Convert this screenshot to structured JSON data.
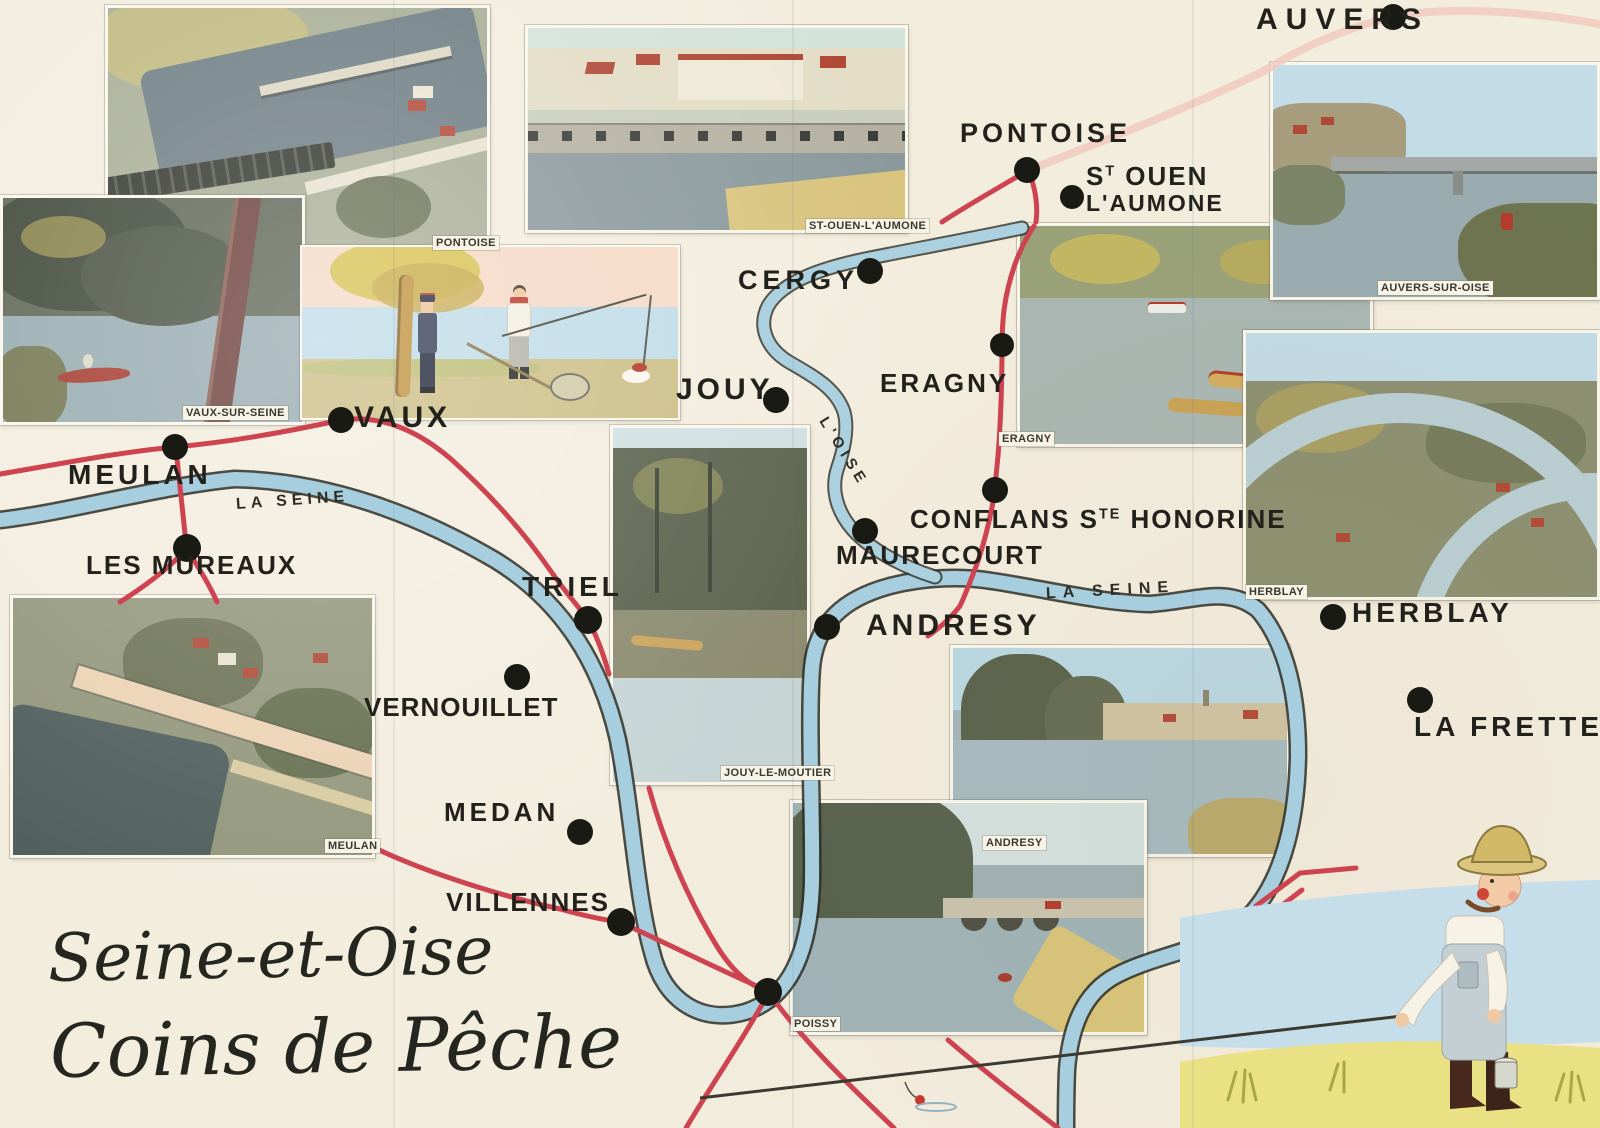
{
  "title": {
    "line1": "Seine-et-Oise",
    "line2": "Coins de Pêche"
  },
  "towns": [
    {
      "id": "auvers",
      "label": "AUVERS"
    },
    {
      "id": "pontoise",
      "label": "PONTOISE"
    },
    {
      "id": "st-ouen-l-aumone",
      "line1_s": "S",
      "line1_sup": "T",
      "line1_rest": " OUEN",
      "line2": "L'AUMONE"
    },
    {
      "id": "cergy",
      "label": "CERGY"
    },
    {
      "id": "jouy",
      "label": "JOUY"
    },
    {
      "id": "eragny",
      "label": "ERAGNY"
    },
    {
      "id": "conflans-ste-honorine",
      "p1": "CONFLANS S",
      "sup": "TE",
      "p2": " HONORINE"
    },
    {
      "id": "maurecourt",
      "label": "MAURECOURT"
    },
    {
      "id": "andresy",
      "label": "ANDRESY"
    },
    {
      "id": "herblay",
      "label": "HERBLAY"
    },
    {
      "id": "la-frette",
      "label": "LA FRETTE"
    },
    {
      "id": "vaux",
      "label": "VAUX"
    },
    {
      "id": "meulan",
      "label": "MEULAN"
    },
    {
      "id": "les-mureaux",
      "label": "LES MUREAUX"
    },
    {
      "id": "triel",
      "label": "TRIEL"
    },
    {
      "id": "vernouillet",
      "label": "VERNOUILLET"
    },
    {
      "id": "medan",
      "label": "MEDAN"
    },
    {
      "id": "villennes",
      "label": "VILLENNES"
    }
  ],
  "river_labels": {
    "seine_west": "LA SEINE",
    "seine_east": "LA SEINE",
    "oise": "L'OISE"
  },
  "photo_captions": [
    "PONTOISE",
    "ST-OUEN-L'AUMONE",
    "VAUX-SUR-SEINE",
    "AUVERS-SUR-OISE",
    "ERAGNY",
    "HERBLAY",
    "JOUY-LE-MOUTIER",
    "MEULAN",
    "ANDRESY",
    "POISSY"
  ],
  "colors": {
    "paper": "#f3edde",
    "river_fill": "#a6cede",
    "river_edge": "#2e2e26",
    "road_red": "#ce4350",
    "road_pale": "#f0cabe",
    "dot": "#1a1a15",
    "label": "#23211c"
  }
}
